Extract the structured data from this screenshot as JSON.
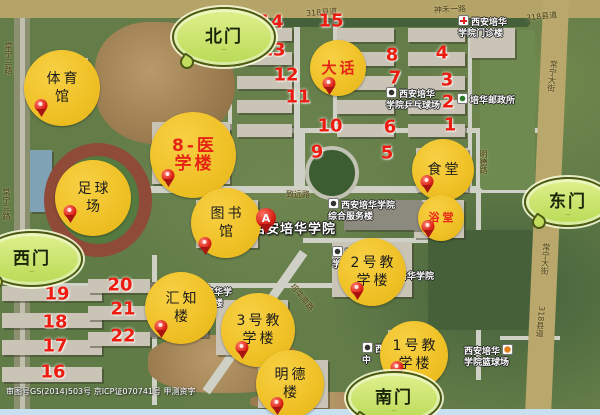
{
  "map": {
    "name": "campus-satellite-map",
    "copyright": "审图号GS(2014)503号 京ICP证070741号 甲测资字",
    "colors": {
      "marker_yellow": "#f0c228",
      "gate_green": "#c6e467",
      "number_red": "#ed1c10",
      "pin_red": "#d81e12",
      "poi_red_text": "#e62517"
    },
    "main_place": {
      "name": "西安培华学院",
      "pin_letter": "A",
      "label_x": 252,
      "label_y": 218,
      "pin_x": 266,
      "pin_y": 228
    },
    "gates": [
      {
        "id": "north",
        "label": "北门",
        "x": 222,
        "y": 35,
        "w": 100,
        "h": 56
      },
      {
        "id": "east",
        "label": "东门",
        "x": 566,
        "y": 200,
        "w": 84,
        "h": 46
      },
      {
        "id": "west",
        "label": "西门",
        "x": 30,
        "y": 257,
        "w": 98,
        "h": 52
      },
      {
        "id": "south",
        "label": "南门",
        "x": 392,
        "y": 396,
        "w": 92,
        "h": 50
      }
    ],
    "poi_markers": [
      {
        "id": "gymnasium",
        "lines": [
          "体育",
          "馆"
        ],
        "x": 62,
        "y": 88,
        "r": 38,
        "red": false,
        "pin": {
          "x": 41,
          "y": 112
        }
      },
      {
        "id": "football-field",
        "lines": [
          "足球",
          "场"
        ],
        "x": 93,
        "y": 198,
        "r": 38,
        "red": false,
        "pin": {
          "x": 70,
          "y": 218
        }
      },
      {
        "id": "medical-building-8",
        "lines": [
          "8-医",
          "学楼"
        ],
        "x": 193,
        "y": 155,
        "r": 43,
        "red": true,
        "size": 17,
        "pin": {
          "x": 168,
          "y": 182
        }
      },
      {
        "id": "library",
        "lines": [
          "图书",
          "馆"
        ],
        "x": 226,
        "y": 223,
        "r": 35,
        "red": false,
        "pin": {
          "x": 205,
          "y": 250
        }
      },
      {
        "id": "dahua",
        "lines": [
          "大话"
        ],
        "x": 338,
        "y": 68,
        "r": 28,
        "red": true,
        "size": 15,
        "pin": {
          "x": 329,
          "y": 90
        }
      },
      {
        "id": "canteen",
        "lines": [
          "食堂"
        ],
        "x": 443,
        "y": 170,
        "r": 31,
        "red": false,
        "pin": {
          "x": 427,
          "y": 188
        }
      },
      {
        "id": "bath-house",
        "lines": [
          "浴堂"
        ],
        "x": 441,
        "y": 218,
        "r": 23,
        "red": true,
        "size": 11,
        "pin": {
          "x": 428,
          "y": 233
        }
      },
      {
        "id": "teaching-building-2",
        "lines": [
          "2号教",
          "学楼"
        ],
        "x": 372,
        "y": 272,
        "r": 34,
        "red": false,
        "pin": {
          "x": 357,
          "y": 295
        }
      },
      {
        "id": "huizhi-building",
        "lines": [
          "汇知",
          "楼"
        ],
        "x": 181,
        "y": 308,
        "r": 36,
        "red": false,
        "pin": {
          "x": 161,
          "y": 333
        }
      },
      {
        "id": "teaching-building-3",
        "lines": [
          "3号教",
          "学楼"
        ],
        "x": 258,
        "y": 330,
        "r": 37,
        "red": false,
        "pin": {
          "x": 242,
          "y": 354
        }
      },
      {
        "id": "mingde-building",
        "lines": [
          "明德",
          "楼"
        ],
        "x": 290,
        "y": 384,
        "r": 34,
        "red": false,
        "pin": {
          "x": 277,
          "y": 410
        }
      },
      {
        "id": "teaching-building-1",
        "lines": [
          "1号教",
          "学楼"
        ],
        "x": 414,
        "y": 355,
        "r": 34,
        "red": false,
        "pin": {
          "x": 397,
          "y": 374
        }
      }
    ],
    "building_numbers": [
      {
        "n": "14",
        "x": 271,
        "y": 22
      },
      {
        "n": "15",
        "x": 331,
        "y": 21
      },
      {
        "n": "13",
        "x": 273,
        "y": 50
      },
      {
        "n": "12",
        "x": 286,
        "y": 75
      },
      {
        "n": "11",
        "x": 298,
        "y": 97
      },
      {
        "n": "10",
        "x": 330,
        "y": 126
      },
      {
        "n": "9",
        "x": 317,
        "y": 152
      },
      {
        "n": "8",
        "x": 392,
        "y": 55
      },
      {
        "n": "4",
        "x": 442,
        "y": 53
      },
      {
        "n": "7",
        "x": 395,
        "y": 78
      },
      {
        "n": "3",
        "x": 447,
        "y": 80
      },
      {
        "n": "2",
        "x": 448,
        "y": 102
      },
      {
        "n": "6",
        "x": 390,
        "y": 127
      },
      {
        "n": "1",
        "x": 450,
        "y": 125
      },
      {
        "n": "5",
        "x": 387,
        "y": 153
      },
      {
        "n": "19",
        "x": 57,
        "y": 294
      },
      {
        "n": "20",
        "x": 120,
        "y": 285
      },
      {
        "n": "18",
        "x": 55,
        "y": 322
      },
      {
        "n": "21",
        "x": 123,
        "y": 309
      },
      {
        "n": "17",
        "x": 55,
        "y": 346
      },
      {
        "n": "22",
        "x": 123,
        "y": 336
      },
      {
        "n": "16",
        "x": 53,
        "y": 372
      }
    ],
    "place_labels": [
      {
        "id": "clinic",
        "lines": [
          "西安培华",
          "学院门诊楼"
        ],
        "x": 458,
        "y": 15,
        "icon": "cross",
        "under": false
      },
      {
        "id": "pingpong-court",
        "lines": [
          "西安培华",
          "学院乒乓球场"
        ],
        "x": 386,
        "y": 87,
        "icon": "dot",
        "under": false
      },
      {
        "id": "post-office",
        "lines": [
          "培华邮政所"
        ],
        "x": 457,
        "y": 93,
        "icon": "post",
        "under": false
      },
      {
        "id": "service-building",
        "lines": [
          "西安培华学院",
          "综合服务楼"
        ],
        "x": 328,
        "y": 198,
        "icon": "dot",
        "under": false
      },
      {
        "id": "label-frag-a",
        "lines": [
          "西安培华",
          "学院"
        ],
        "x": 332,
        "y": 246,
        "icon": "dot",
        "under": true
      },
      {
        "id": "label-frag-b",
        "lines": [
          "培华学院"
        ],
        "x": 398,
        "y": 272,
        "icon": "none",
        "under": true
      },
      {
        "id": "huizhi-label",
        "lines": [
          "安培华学",
          "汇知楼"
        ],
        "x": 196,
        "y": 288,
        "icon": "none",
        "under": true
      },
      {
        "id": "basketball-court",
        "lines": [
          "西安培华",
          "学院篮球场"
        ],
        "x": 464,
        "y": 344,
        "icon": "ball",
        "under": false,
        "icon_right": true
      },
      {
        "id": "label-frag-west",
        "lines": [
          "西安",
          "中"
        ],
        "x": 362,
        "y": 342,
        "icon": "dot",
        "under": true
      }
    ],
    "road_labels": [
      {
        "text": "318县道",
        "x": 306,
        "y": 7,
        "angle": -4
      },
      {
        "text": "神禾一路",
        "x": 434,
        "y": 4,
        "angle": -3
      },
      {
        "text": "318县道",
        "x": 526,
        "y": 11,
        "angle": -6
      },
      {
        "text": "常宁大街",
        "x": 547,
        "y": 60,
        "vertical": true,
        "angle": 6
      },
      {
        "text": "常宁大街",
        "x": 540,
        "y": 243,
        "vertical": true,
        "angle": 4
      },
      {
        "text": "318县道",
        "x": 535,
        "y": 306,
        "vertical": true,
        "angle": 4
      },
      {
        "text": "常宁三路",
        "x": 3,
        "y": 42,
        "vertical": true,
        "angle": 0
      },
      {
        "text": "常宁三路",
        "x": 1,
        "y": 188,
        "vertical": true,
        "angle": 0
      },
      {
        "text": "致远路",
        "x": 286,
        "y": 189,
        "angle": 0
      },
      {
        "text": "明德路",
        "x": 478,
        "y": 150,
        "vertical": true,
        "angle": 0
      },
      {
        "text": "培华南路",
        "x": 286,
        "y": 292,
        "angle": 52
      },
      {
        "text": "培华南路",
        "x": 414,
        "y": 384,
        "angle": 50
      }
    ]
  }
}
